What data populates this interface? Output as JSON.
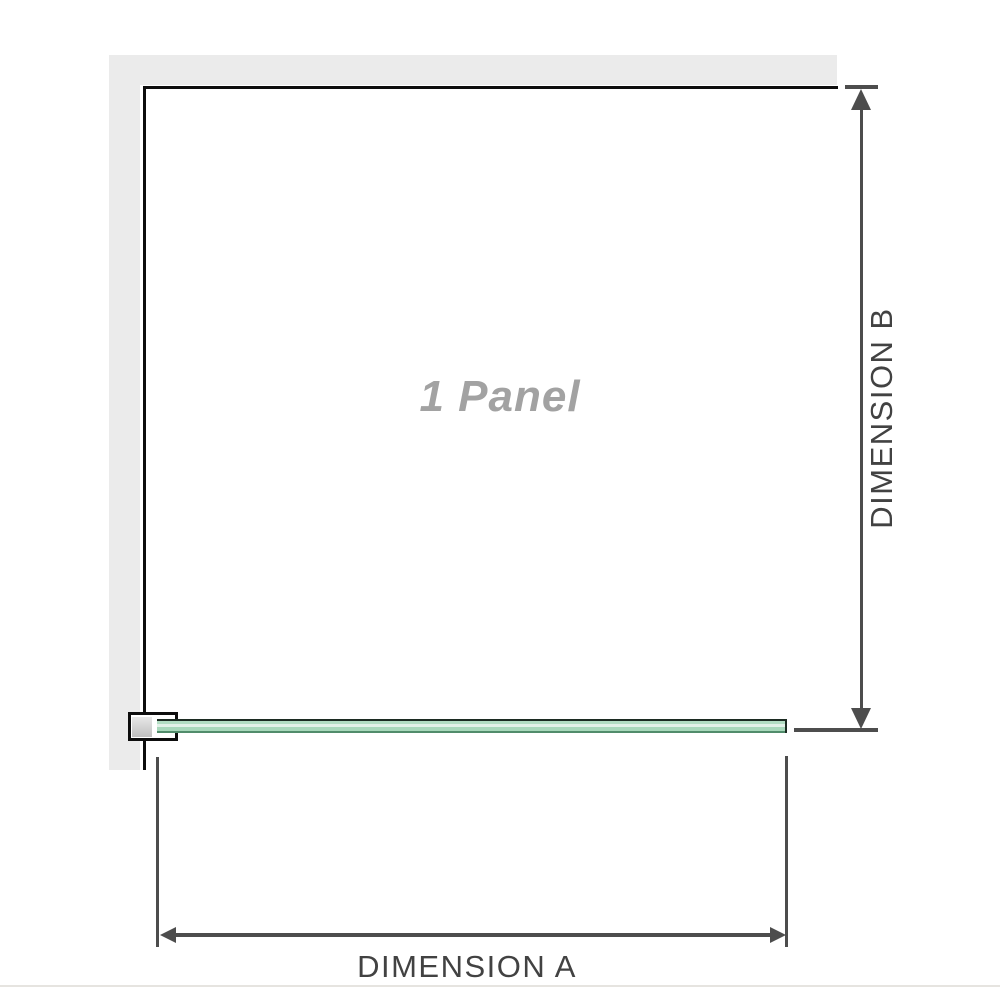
{
  "diagram": {
    "panel_label": "1 Panel",
    "dimension_a": {
      "label": "DIMENSION A"
    },
    "dimension_b": {
      "label": "DIMENSION B"
    },
    "colors": {
      "wall_fill": "#ebebeb",
      "wall_edge": "#0d0d0d",
      "glass_fill": "#a8d8bb",
      "glass_highlight": "#e2f1e8",
      "glass_edge_top": "#1c2b22",
      "glass_edge_bottom": "#518c6b",
      "bracket_border": "#0d0d0d",
      "bracket_insert": "#bfbfbf",
      "dimension_lines": "#4d4d4d",
      "dimension_text": "#424242",
      "panel_label_text": "#a2a2a2",
      "divider": "#e6e4e0",
      "background": "#ffffff"
    }
  }
}
